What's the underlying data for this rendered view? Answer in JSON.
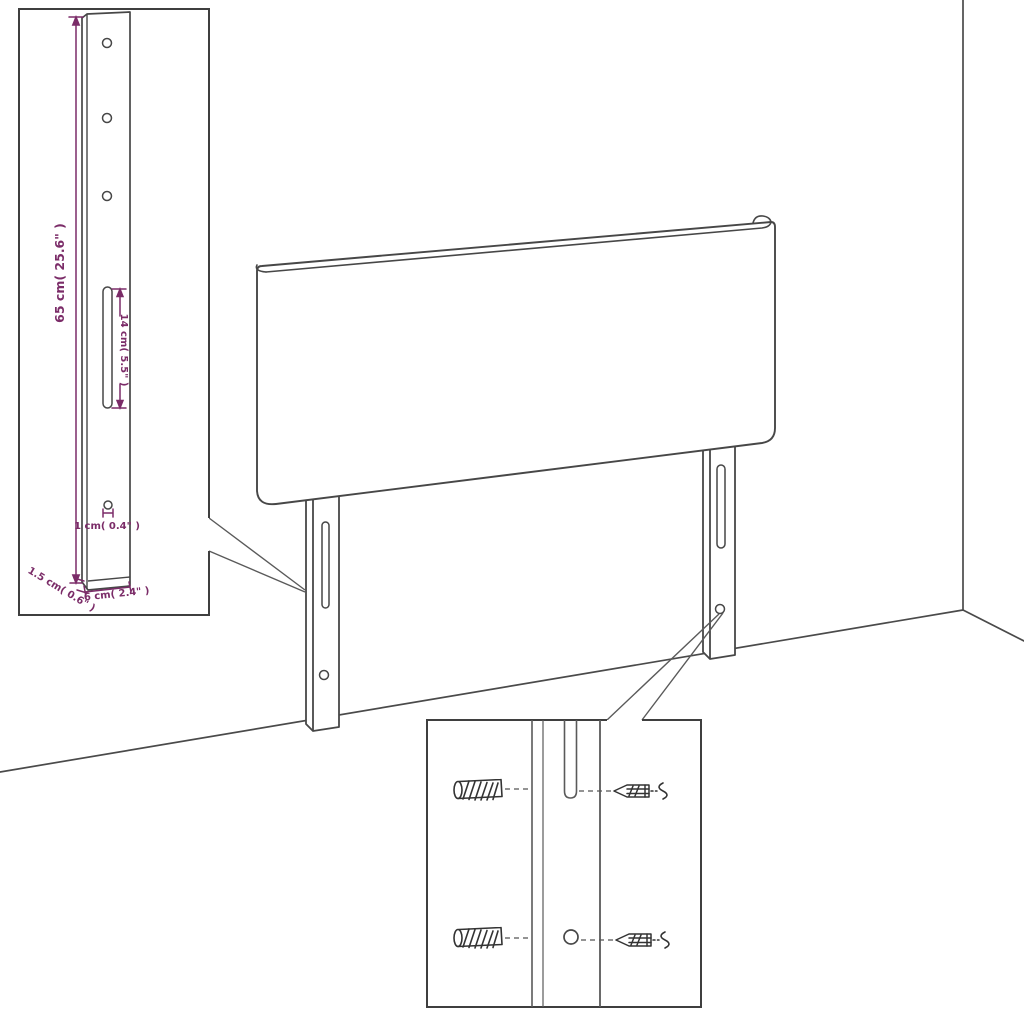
{
  "diagram": {
    "background_color": "#ffffff",
    "line_color": "#474747",
    "dimension_color": "#7b2c68",
    "main_view": {
      "subject": "upholstered headboard panel with two mounting legs standing in a room corner",
      "legs_count": 2
    },
    "leg_inset": {
      "round_holes_count": 4,
      "labels": {
        "height": "65 cm( 25.6\" )",
        "slot": "14 cm( 5.5\" )",
        "hole": "1 cm( 0.4\" )",
        "thickness": "1.5 cm( 0.6\" )",
        "width": "6 cm( 2.4\" )"
      }
    },
    "hardware_inset": {
      "rows": 2,
      "items_per_row": [
        "wall-plug",
        "screw",
        "spring-washer"
      ]
    }
  }
}
